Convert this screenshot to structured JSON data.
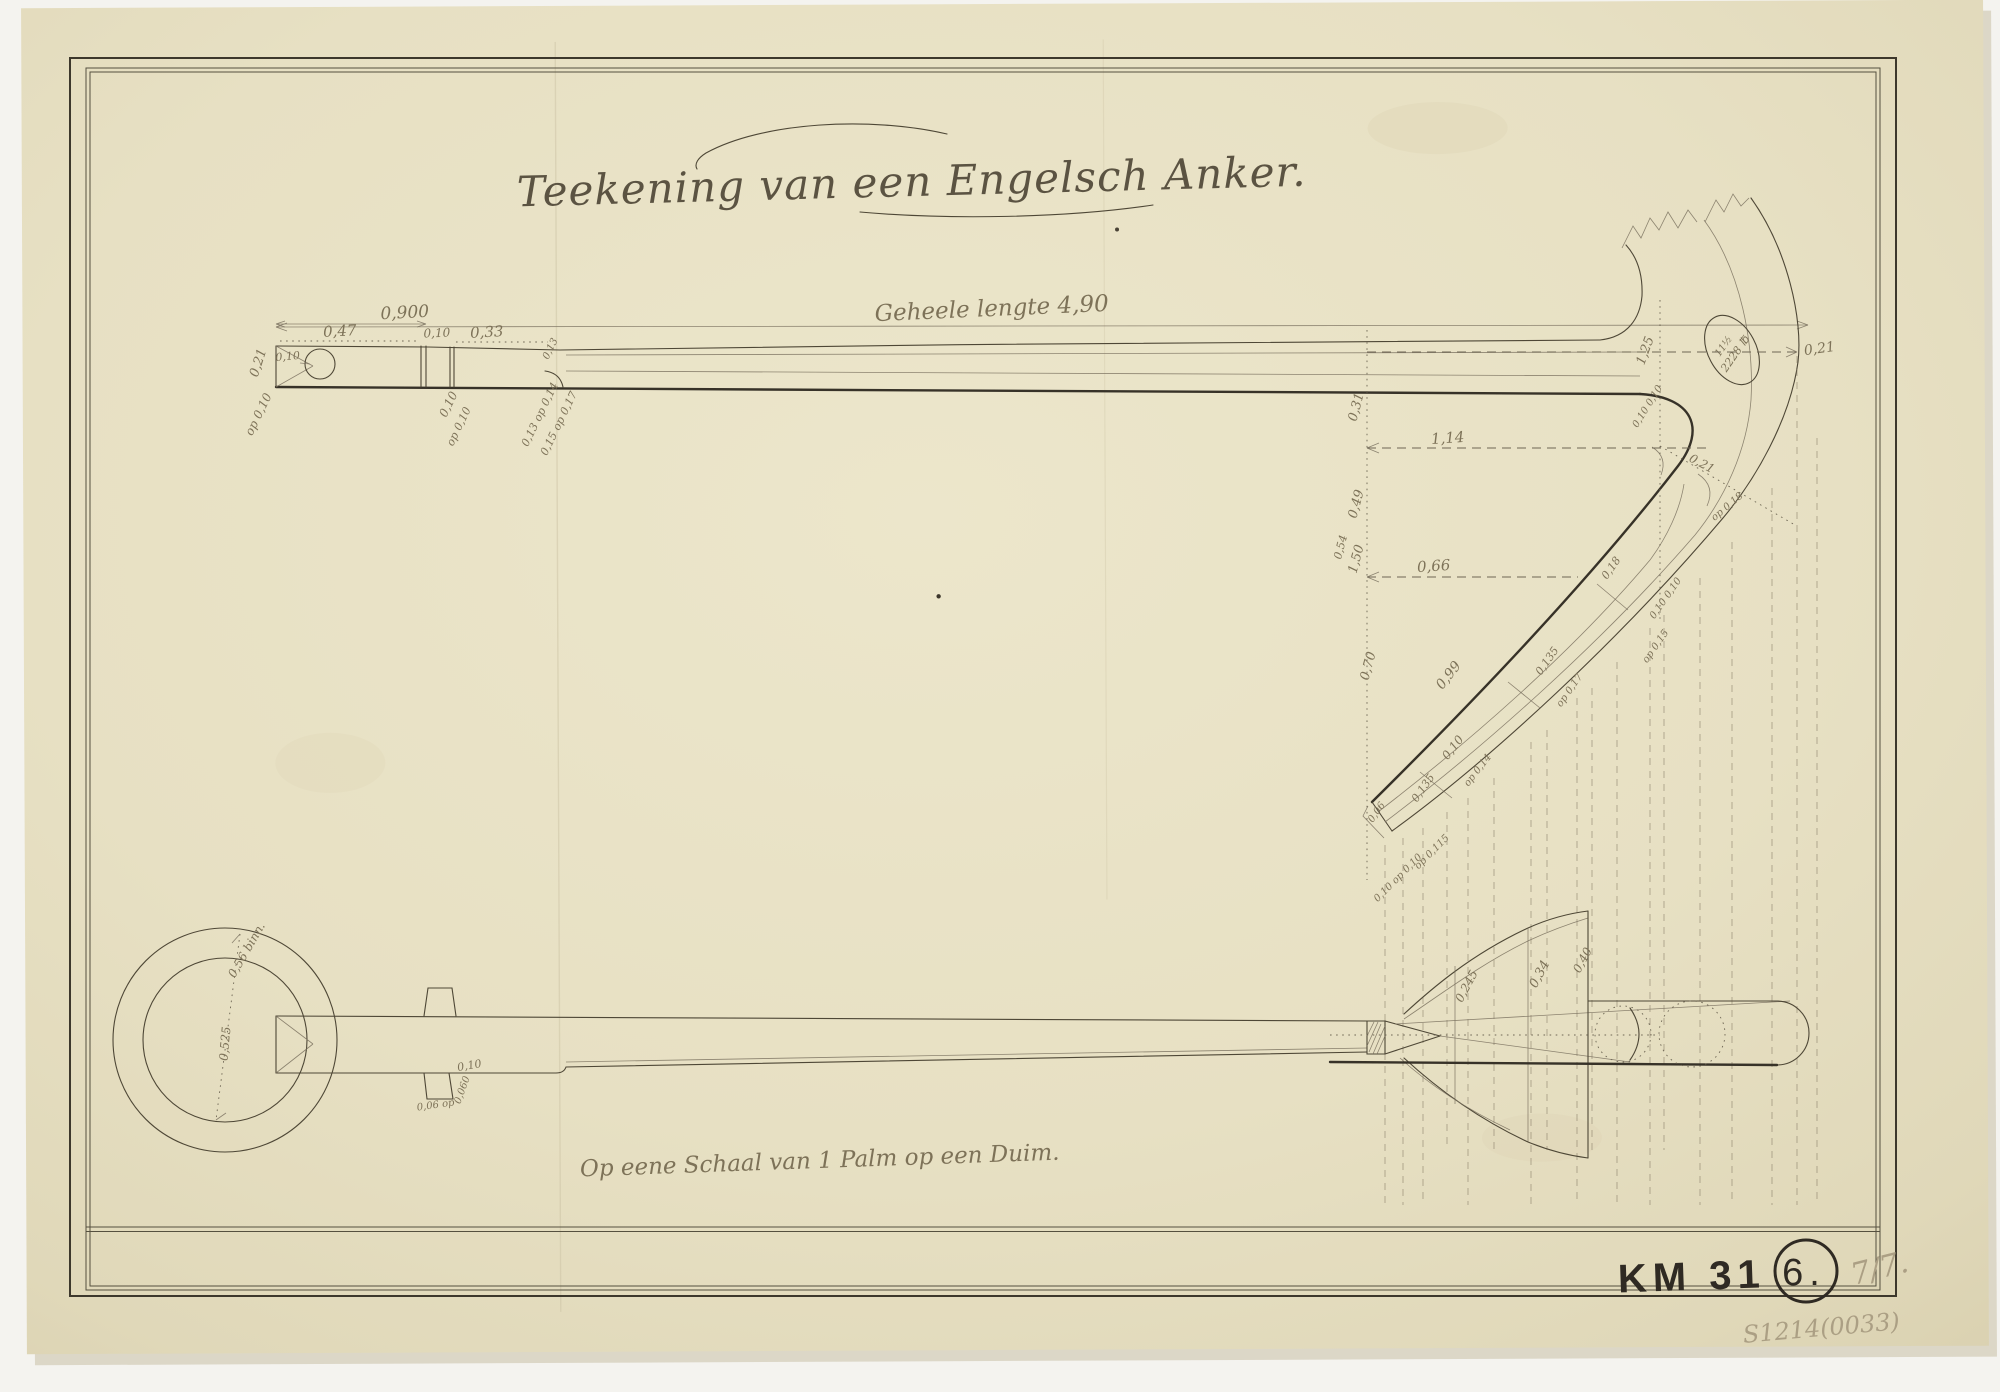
{
  "drawing": {
    "title": "Teekening van een Engelsch Anker.",
    "length_note": "Geheele lengte 4,90",
    "scale_note": "Op eene Schaal van 1 Palm op een Duim.",
    "weight_mark": {
      "line1": "11½",
      "line2": "2228 ℔"
    },
    "marks": {
      "inventory": "KM 31",
      "sheet_number": "6.",
      "pencil_mark": "7/7.",
      "catalog_number": "S1214(0033)"
    }
  },
  "dims": {
    "d01": "0,900",
    "d02": "0,47",
    "d03": "0,10",
    "d04": "0,33",
    "d05": "0,21",
    "d06": "0,10",
    "d07": "op 0,10",
    "d08": "0,10",
    "d09": "op 0,10",
    "d10": "0,13",
    "d11": "0,13 op 0,14",
    "d12": "0,15 op 0,17",
    "d14": "1,25",
    "d15": "0,21",
    "d16": "0,31",
    "d17": "1,14",
    "d18": "0,49",
    "d19": "0,54",
    "d20": "1,50",
    "d21": "0,66",
    "d22": "0,70",
    "d23": "0,10 0,10",
    "d24": "0,21",
    "d25": "op 0,18",
    "d26": "0,18",
    "d27": "0,135",
    "d28": "op 0,17",
    "d29": "0,10 0,10",
    "d30": "op 0,15",
    "d31": "0,99",
    "d32": "0,10",
    "d33": "op 0,14",
    "d34": "0,135",
    "d35": "0,06",
    "d36": "op 0,115",
    "d37": "0,10 op 0,10",
    "d40": "0,56 binn.",
    "d41": "0,525",
    "d42": "0,10",
    "d43": "0,060",
    "d44": "0,06 op",
    "d45": "0,245",
    "d46": "0,34",
    "d47": "0,40"
  }
}
